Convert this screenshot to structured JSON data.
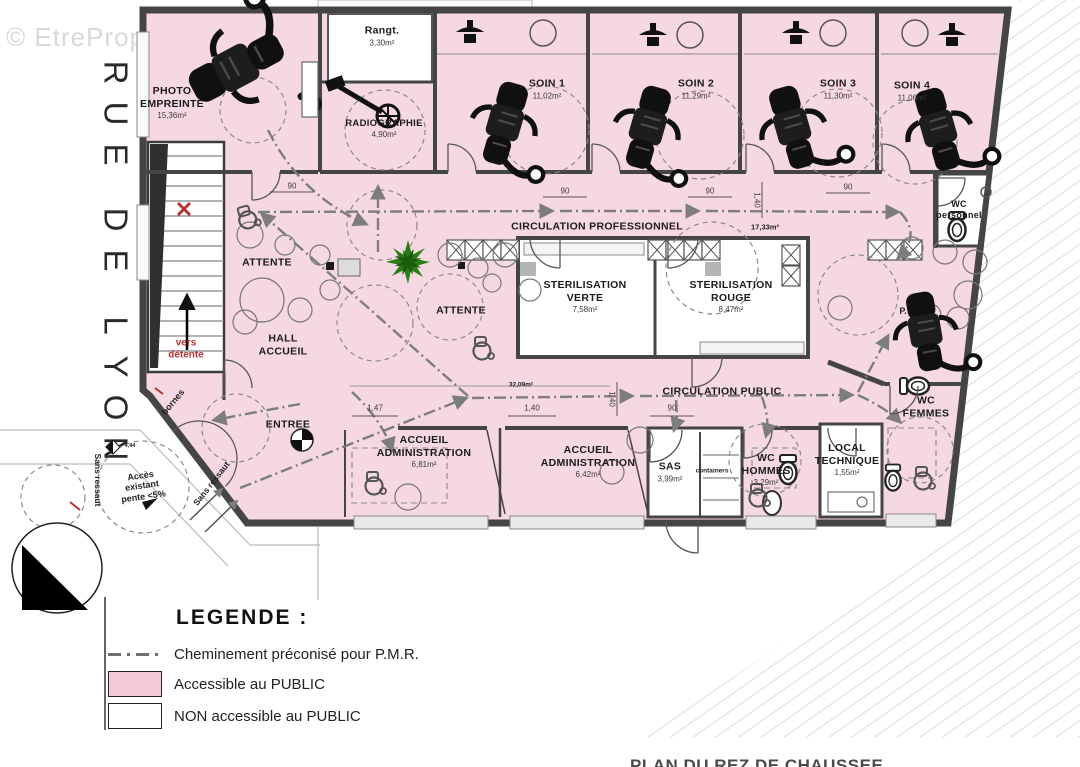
{
  "watermark": "© EtreProprio.com",
  "street_name": "RUE DE LYON",
  "caption": "PLAN DU REZ DE CHAUSSEE",
  "colors": {
    "accessible_public_pink": "#f6c9d6",
    "plan_fill_pink": "#f6d8e2",
    "non_public_white": "#ffffff",
    "pmr_path_gray": "#7d7d7d",
    "wall_gray": "#454545",
    "red_accent": "#b73233",
    "plant_green": "#2a7d15"
  },
  "legend": {
    "title": "LEGENDE :",
    "items": [
      {
        "id": "pmr-path",
        "label": "Cheminement préconisé pour P.M.R.",
        "swatch": "dashdot-line"
      },
      {
        "id": "accessible-public",
        "label": "Accessible au PUBLIC",
        "swatch": "#f6c9d6"
      },
      {
        "id": "non-accessible-public",
        "label": "NON accessible au PUBLIC",
        "swatch": "#ffffff"
      }
    ]
  },
  "plan": {
    "rooms": [
      {
        "id": "photo-empreinte",
        "name": "PHOTO\nEMPREINTE",
        "area": "15,36m²",
        "x": 172,
        "y": 103
      },
      {
        "id": "rangement",
        "name": "Rangt.",
        "area": "3,30m²",
        "x": 382,
        "y": 36
      },
      {
        "id": "radiographie",
        "name": "RADIOGRAPHIE",
        "area": "4,90m²",
        "x": 384,
        "y": 129,
        "fs": 9.5
      },
      {
        "id": "soin-1",
        "name": "SOIN 1",
        "area": "11,02m²",
        "x": 547,
        "y": 89
      },
      {
        "id": "soin-2",
        "name": "SOIN 2",
        "area": "11,29m²",
        "x": 696,
        "y": 89
      },
      {
        "id": "soin-3",
        "name": "SOIN 3",
        "area": "11,30m²",
        "x": 838,
        "y": 89
      },
      {
        "id": "soin-4",
        "name": "SOIN 4",
        "area": "11,06m²",
        "x": 912,
        "y": 91
      },
      {
        "id": "circulation-professionnel",
        "name": "CIRCULATION PROFESSIONNEL",
        "x": 597,
        "y": 227
      },
      {
        "id": "sterilisation-verte",
        "name": "STERILISATION\nVERTE",
        "area": "7,58m²",
        "x": 585,
        "y": 297
      },
      {
        "id": "sterilisation-rouge",
        "name": "STERILISATION\nROUGE",
        "area": "8,47m²",
        "x": 731,
        "y": 297
      },
      {
        "id": "wc-personnel",
        "name": "WC\npersonnel",
        "x": 959,
        "y": 210,
        "fs": 9
      },
      {
        "id": "attente-hall",
        "name": "ATTENTE",
        "x": 267,
        "y": 263
      },
      {
        "id": "attente-centre",
        "name": "ATTENTE",
        "x": 461,
        "y": 311
      },
      {
        "id": "hall-accueil",
        "name": "HALL\nACCUEIL",
        "x": 283,
        "y": 345
      },
      {
        "id": "entree",
        "name": "ENTREE",
        "x": 288,
        "y": 425
      },
      {
        "id": "accueil-administration-1",
        "name": "ACCUEIL\nADMINISTRATION",
        "area": "6,81m²",
        "x": 424,
        "y": 452
      },
      {
        "id": "accueil-administration-2",
        "name": "ACCUEIL\nADMINISTRATION",
        "area": "6,42m²",
        "x": 588,
        "y": 462
      },
      {
        "id": "circulation-public",
        "name": "CIRCULATION PUBLIC",
        "x": 722,
        "y": 392
      },
      {
        "id": "sas",
        "name": "SAS",
        "area": "3,99m²",
        "x": 670,
        "y": 472
      },
      {
        "id": "wc-hommes",
        "name": "WC\nHOMMES",
        "area": "3,29m²",
        "x": 766,
        "y": 470
      },
      {
        "id": "local-technique",
        "name": "LOCAL\nTECHNIQUE",
        "area": "1,55m²",
        "x": 847,
        "y": 460
      },
      {
        "id": "wc-femmes",
        "name": "WC\nFEMMES",
        "x": 926,
        "y": 407
      }
    ],
    "annotations": [
      {
        "id": "circulation-professionnel-area",
        "text": "17,33m²",
        "x": 765,
        "y": 228,
        "fs": 7.5
      },
      {
        "id": "circulation-public-area",
        "text": "32,09m²",
        "x": 521,
        "y": 385,
        "fs": 6.5
      },
      {
        "id": "containers",
        "text": "containers",
        "x": 712,
        "y": 471,
        "fs": 6.5
      },
      {
        "id": "vers-detente",
        "text": "vers\ndétente",
        "x": 186,
        "y": 349,
        "cls": "red",
        "fs": 10
      },
      {
        "id": "bornes",
        "text": "bornes",
        "x": 173,
        "y": 402,
        "rot": -50,
        "fs": 9
      },
      {
        "id": "sans-ressaut-gauche",
        "text": "Sans ressaut",
        "x": 97,
        "y": 480,
        "rot": 90,
        "fs": 8.5
      },
      {
        "id": "sans-ressaut-entree",
        "text": "Sans ressaut",
        "x": 212,
        "y": 484,
        "rot": -52,
        "fs": 8.5
      },
      {
        "id": "acces-existant",
        "text": "Accès\nexistant\npente <5%",
        "x": 142,
        "y": 486,
        "rot": -8,
        "fs": 9
      },
      {
        "id": "pmr-point",
        "text": "P.",
        "x": 903,
        "y": 311,
        "fs": 9
      },
      {
        "id": "niveau-444",
        "text": "4,44",
        "x": 130,
        "y": 446,
        "fs": 5.5
      }
    ],
    "dimensions": [
      {
        "text": "90",
        "x": 292,
        "y": 186
      },
      {
        "text": "90",
        "x": 565,
        "y": 191
      },
      {
        "text": "90",
        "x": 710,
        "y": 191
      },
      {
        "text": "90",
        "x": 848,
        "y": 187
      },
      {
        "text": "1,40",
        "x": 757,
        "y": 200,
        "rot": 90
      },
      {
        "text": "1,47",
        "x": 375,
        "y": 408
      },
      {
        "text": "1,40",
        "x": 532,
        "y": 408
      },
      {
        "text": "90",
        "x": 672,
        "y": 408
      },
      {
        "text": "1,40",
        "x": 612,
        "y": 399,
        "rot": 90
      }
    ]
  }
}
